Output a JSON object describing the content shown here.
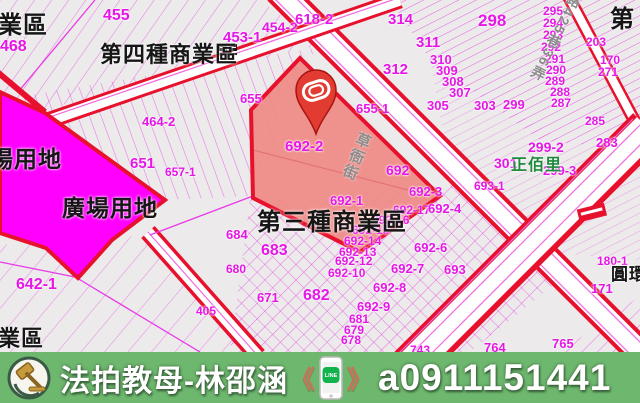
{
  "banner": {
    "brand": "法拍教母-林邵涵",
    "quote_open": "《",
    "quote_close": "》",
    "line_label": "LINE",
    "phone": "a0911151441",
    "bg_color": "#6eb76e",
    "quote_color": "#cd7257"
  },
  "map": {
    "highlighted_parcel": "692-2",
    "colors": {
      "plaza_zone_magenta": "#ff00ff",
      "highlight_fill": "#ef8a85",
      "zone_border_red": "#e8112d",
      "parcel_line_magenta": "#e616e6",
      "road_label_gray": "#8c8c8c",
      "village_green": "#1e8c3c"
    },
    "zone_labels": [
      {
        "t": "業區",
        "x": -2,
        "y": 14,
        "s": 24
      },
      {
        "t": "第四種商業區",
        "x": 100,
        "y": 44,
        "s": 22
      },
      {
        "t": "場用地",
        "x": -10,
        "y": 148,
        "s": 23
      },
      {
        "t": "廣場用地",
        "x": 62,
        "y": 197,
        "s": 23
      },
      {
        "t": "第三種商業區",
        "x": 257,
        "y": 211,
        "s": 24
      },
      {
        "t": "業區",
        "x": -2,
        "y": 328,
        "s": 22
      },
      {
        "t": "第",
        "x": 610,
        "y": 8,
        "s": 24
      },
      {
        "t": "圓環",
        "x": 611,
        "y": 266,
        "s": 17
      },
      {
        "t": "正佰里",
        "x": 511,
        "y": 158,
        "s": 16,
        "c": "#1e8c3c"
      }
    ],
    "road_labels": [
      {
        "t": "草衙街",
        "x": 358,
        "y": 133,
        "s": 15,
        "rot": 22
      },
      {
        "t": "路425巷36弄",
        "x": 570,
        "y": -6,
        "s": 14,
        "rot": 26
      }
    ],
    "parcel_labels": [
      {
        "t": "455",
        "x": 103,
        "y": 8,
        "s": 16
      },
      {
        "t": "468",
        "x": 0,
        "y": 39,
        "s": 16
      },
      {
        "t": "453-1",
        "x": 223,
        "y": 30,
        "s": 15
      },
      {
        "t": "454-2",
        "x": 262,
        "y": 20,
        "s": 14
      },
      {
        "t": "618-2",
        "x": 295,
        "y": 12,
        "s": 15
      },
      {
        "t": "314",
        "x": 388,
        "y": 12,
        "s": 15
      },
      {
        "t": "311",
        "x": 416,
        "y": 35,
        "s": 15
      },
      {
        "t": "312",
        "x": 383,
        "y": 62,
        "s": 15
      },
      {
        "t": "298",
        "x": 478,
        "y": 12,
        "s": 17
      },
      {
        "t": "310",
        "x": 430,
        "y": 53,
        "s": 13
      },
      {
        "t": "309",
        "x": 436,
        "y": 64,
        "s": 13
      },
      {
        "t": "308",
        "x": 442,
        "y": 75,
        "s": 13
      },
      {
        "t": "307",
        "x": 449,
        "y": 86,
        "s": 13
      },
      {
        "t": "305",
        "x": 427,
        "y": 99,
        "s": 13
      },
      {
        "t": "303",
        "x": 474,
        "y": 99,
        "s": 13
      },
      {
        "t": "299",
        "x": 503,
        "y": 98,
        "s": 13
      },
      {
        "t": "295",
        "x": 543,
        "y": 5,
        "s": 12
      },
      {
        "t": "294",
        "x": 543,
        "y": 17,
        "s": 12
      },
      {
        "t": "293",
        "x": 543,
        "y": 29,
        "s": 12
      },
      {
        "t": "292",
        "x": 541,
        "y": 41,
        "s": 12
      },
      {
        "t": "291",
        "x": 545,
        "y": 53,
        "s": 12
      },
      {
        "t": "290",
        "x": 546,
        "y": 64,
        "s": 12
      },
      {
        "t": "289",
        "x": 545,
        "y": 75,
        "s": 12
      },
      {
        "t": "288",
        "x": 550,
        "y": 86,
        "s": 12
      },
      {
        "t": "287",
        "x": 551,
        "y": 97,
        "s": 12
      },
      {
        "t": "285",
        "x": 585,
        "y": 115,
        "s": 12
      },
      {
        "t": "203",
        "x": 586,
        "y": 36,
        "s": 12
      },
      {
        "t": "170",
        "x": 600,
        "y": 54,
        "s": 12
      },
      {
        "t": "271",
        "x": 598,
        "y": 66,
        "s": 12
      },
      {
        "t": "299-2",
        "x": 528,
        "y": 140,
        "s": 14
      },
      {
        "t": "301",
        "x": 494,
        "y": 156,
        "s": 14
      },
      {
        "t": "299-3",
        "x": 543,
        "y": 164,
        "s": 13
      },
      {
        "t": "283",
        "x": 596,
        "y": 136,
        "s": 13
      },
      {
        "t": "655",
        "x": 240,
        "y": 92,
        "s": 13
      },
      {
        "t": "655-1",
        "x": 356,
        "y": 102,
        "s": 13
      },
      {
        "t": "651",
        "x": 130,
        "y": 156,
        "s": 15
      },
      {
        "t": "464-2",
        "x": 142,
        "y": 115,
        "s": 13
      },
      {
        "t": "657-1",
        "x": 165,
        "y": 166,
        "s": 12
      },
      {
        "t": "692-2",
        "x": 285,
        "y": 139,
        "s": 15
      },
      {
        "t": "692",
        "x": 386,
        "y": 163,
        "s": 14
      },
      {
        "t": "692-1",
        "x": 330,
        "y": 194,
        "s": 13
      },
      {
        "t": "692-3",
        "x": 409,
        "y": 185,
        "s": 13
      },
      {
        "t": "692-17",
        "x": 393,
        "y": 204,
        "s": 12
      },
      {
        "t": "692-4",
        "x": 428,
        "y": 202,
        "s": 13
      },
      {
        "t": "693-1",
        "x": 474,
        "y": 180,
        "s": 12
      },
      {
        "t": "692-16",
        "x": 372,
        "y": 214,
        "s": 12
      },
      {
        "t": "692-15",
        "x": 352,
        "y": 224,
        "s": 12
      },
      {
        "t": "692-14",
        "x": 344,
        "y": 235,
        "s": 12
      },
      {
        "t": "692-13",
        "x": 339,
        "y": 246,
        "s": 12
      },
      {
        "t": "692-12",
        "x": 335,
        "y": 255,
        "s": 12
      },
      {
        "t": "692-10",
        "x": 328,
        "y": 267,
        "s": 12
      },
      {
        "t": "692-6",
        "x": 414,
        "y": 241,
        "s": 13
      },
      {
        "t": "692-7",
        "x": 391,
        "y": 262,
        "s": 13
      },
      {
        "t": "693",
        "x": 444,
        "y": 263,
        "s": 13
      },
      {
        "t": "692-8",
        "x": 373,
        "y": 281,
        "s": 13
      },
      {
        "t": "692-9",
        "x": 357,
        "y": 300,
        "s": 13
      },
      {
        "t": "684",
        "x": 226,
        "y": 228,
        "s": 13
      },
      {
        "t": "683",
        "x": 261,
        "y": 243,
        "s": 16
      },
      {
        "t": "682",
        "x": 303,
        "y": 288,
        "s": 16
      },
      {
        "t": "671",
        "x": 257,
        "y": 291,
        "s": 13
      },
      {
        "t": "680",
        "x": 226,
        "y": 263,
        "s": 12
      },
      {
        "t": "681",
        "x": 349,
        "y": 313,
        "s": 12
      },
      {
        "t": "679",
        "x": 344,
        "y": 324,
        "s": 12
      },
      {
        "t": "678",
        "x": 341,
        "y": 334,
        "s": 12
      },
      {
        "t": "642-1",
        "x": 16,
        "y": 277,
        "s": 16
      },
      {
        "t": "405",
        "x": 196,
        "y": 305,
        "s": 12
      },
      {
        "t": "180-1",
        "x": 597,
        "y": 255,
        "s": 12
      },
      {
        "t": "171",
        "x": 591,
        "y": 282,
        "s": 13
      },
      {
        "t": "765",
        "x": 552,
        "y": 337,
        "s": 13
      },
      {
        "t": "764",
        "x": 484,
        "y": 341,
        "s": 13
      },
      {
        "t": "743",
        "x": 410,
        "y": 344,
        "s": 12
      }
    ]
  }
}
